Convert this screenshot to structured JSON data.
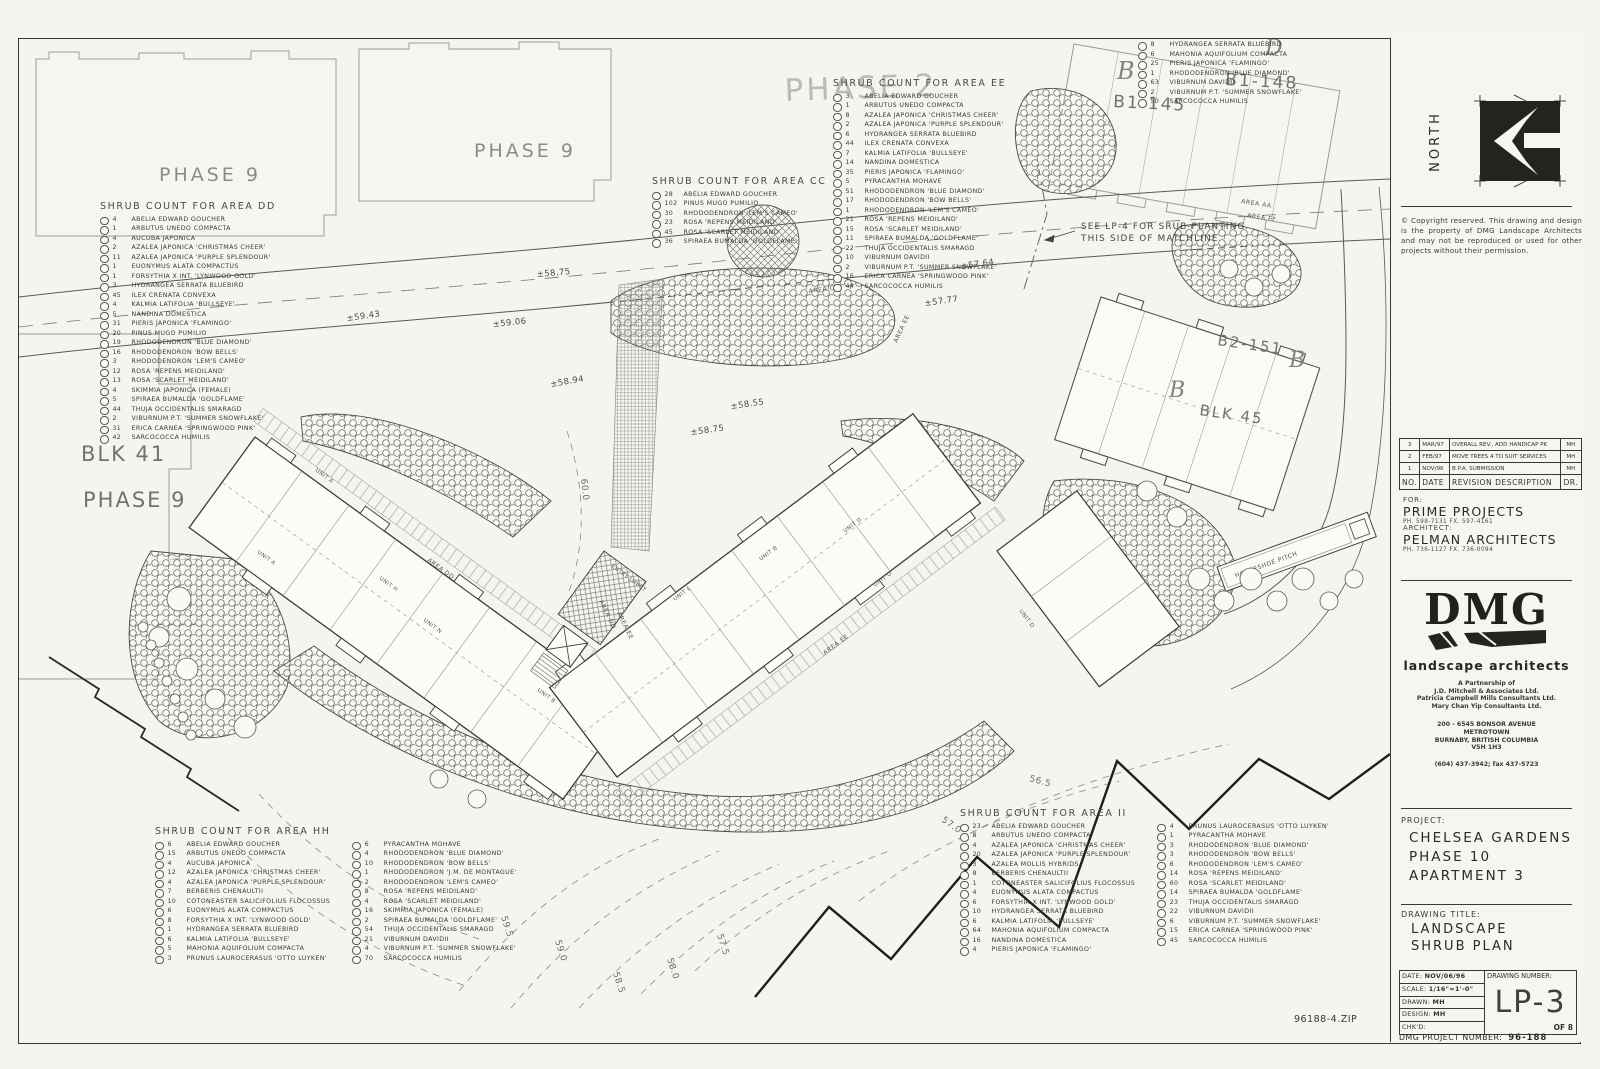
{
  "sheet": {
    "file_note": "96188-4.ZIP"
  },
  "titleblock": {
    "north_label": "NORTH",
    "copyright": "© Copyright reserved. This drawing and design is the property of DMG Landscape Architects and may not be reproduced or used for other projects without their permission.",
    "revisions": {
      "headers": {
        "no": "NO.",
        "date": "DATE",
        "desc": "REVISION  DESCRIPTION",
        "dr": "DR."
      },
      "rows": [
        {
          "no": "3",
          "date": "MAR/97",
          "desc": "OVERALL REV., ADD HANDICAP PK",
          "dr": "MH"
        },
        {
          "no": "2",
          "date": "FEB/97",
          "desc": "MOVE TREES 4 TO SUIT SERVICES",
          "dr": "MH"
        },
        {
          "no": "1",
          "date": "NOV/96",
          "desc": "B.P.A. SUBMISSION",
          "dr": "MH"
        }
      ]
    },
    "for_label": "FOR:",
    "client": "PRIME PROJECTS",
    "client_phone": "PH. 598-7131   FX. 597-4161",
    "architect_label": "ARCHITECT:",
    "architect": "PELMAN ARCHITECTS",
    "architect_phone": "PH. 736-1127   FX. 736-0094",
    "dmg": {
      "logo": "DMG",
      "tagline": "landscape architects",
      "partnership": [
        "A Partnership of",
        "J.D. Mitchell & Associates Ltd.",
        "Patricia Campbell Mills Consultants Ltd.",
        "Mary Chan Yip Consultants Ltd."
      ],
      "address": [
        "200 - 6545 BONSOR AVENUE",
        "METROTOWN",
        "BURNABY, BRITISH COLUMBIA",
        "V5H 1H3"
      ],
      "phone": "(604) 437-3942; fax 437-5723"
    },
    "project_label": "PROJECT:",
    "project_lines": [
      "CHELSEA GARDENS",
      "PHASE 10",
      "APARTMENT 3"
    ],
    "drawing_title_label": "DRAWING TITLE:",
    "drawing_title_lines": [
      "LANDSCAPE",
      "SHRUB PLAN"
    ],
    "info": {
      "date_label": "DATE:",
      "date": "NOV/06/96",
      "scale_label": "SCALE:",
      "scale": "1/16\"=1'-0\"",
      "drawn_label": "DRAWN:",
      "drawn": "MH",
      "design_label": "DESIGN:",
      "design": "MH",
      "chkd_label": "CHK'D:",
      "chkd": ""
    },
    "drawing_number_label": "DRAWING NUMBER:",
    "drawing_number": "LP-3",
    "of_note": "OF 8",
    "dmg_project_label": "DMG  PROJECT  NUMBER:",
    "dmg_project_number": "96-188"
  },
  "lists": {
    "dd": {
      "title": "SHRUB COUNT FOR AREA DD",
      "items": [
        {
          "q": "4",
          "n": "ABELIA EDWARD GOUCHER"
        },
        {
          "q": "1",
          "n": "ARBUTUS UNEDO COMPACTA"
        },
        {
          "q": "4",
          "n": "AUCUBA JAPONICA"
        },
        {
          "q": "2",
          "n": "AZALEA JAPONICA 'CHRISTMAS CHEER'"
        },
        {
          "q": "11",
          "n": "AZALEA JAPONICA 'PURPLE SPLENDOUR'"
        },
        {
          "q": "1",
          "n": "EUONYMUS ALATA COMPACTUS"
        },
        {
          "q": "1",
          "n": "FORSYTHIA X INT. 'LYNWOOD GOLD'"
        },
        {
          "q": "3",
          "n": "HYDRANGEA SERRATA BLUEBIRD"
        },
        {
          "q": "45",
          "n": "ILEX CRENATA CONVEXA"
        },
        {
          "q": "4",
          "n": "KALMIA LATIFOLIA 'BULLSEYE'"
        },
        {
          "q": "5",
          "n": "NANDINA DOMESTICA"
        },
        {
          "q": "31",
          "n": "PIERIS JAPONICA 'FLAMINGO'"
        },
        {
          "q": "20",
          "n": "PINUS MUGO PUMILIO"
        },
        {
          "q": "19",
          "n": "RHODODENDRON 'BLUE DIAMOND'"
        },
        {
          "q": "16",
          "n": "RHODODENDRON 'BOW BELLS'"
        },
        {
          "q": "3",
          "n": "RHODODENDRON 'LEM'S CAMEO'"
        },
        {
          "q": "12",
          "n": "ROSA 'REPENS MEIDILAND'"
        },
        {
          "q": "13",
          "n": "ROSA 'SCARLET MEIDILAND'"
        },
        {
          "q": "4",
          "n": "SKIMMIA JAPONICA (FEMALE)"
        },
        {
          "q": "5",
          "n": "SPIRAEA BUMALDA 'GOLDFLAME'"
        },
        {
          "q": "44",
          "n": "THUJA OCCIDENTALIS SMARAGD"
        },
        {
          "q": "2",
          "n": "VIBURNUM P.T. 'SUMMER SNOWFLAKE'"
        },
        {
          "q": "31",
          "n": "ERICA CARNEA 'SPRINGWOOD PINK'"
        },
        {
          "q": "42",
          "n": "SARCOCOCCA HUMILIS"
        }
      ]
    },
    "cc": {
      "title": "SHRUB COUNT FOR AREA CC",
      "items": [
        {
          "q": "28",
          "n": "ABELIA EDWARD GOUCHER"
        },
        {
          "q": "102",
          "n": "PINUS MUGO PUMILIO"
        },
        {
          "q": "30",
          "n": "RHODODENDRON 'LEM'S CAMEO'"
        },
        {
          "q": "23",
          "n": "ROSA 'REPENS MEIDILAND'"
        },
        {
          "q": "45",
          "n": "ROSA 'SCARLET MEIDILAND'"
        },
        {
          "q": "36",
          "n": "SPIRAEA BUMALDA 'GOLDFLAME'"
        }
      ]
    },
    "ee": {
      "title": "SHRUB COUNT FOR AREA EE",
      "items": [
        {
          "q": "3",
          "n": "ABELIA EDWARD GOUCHER"
        },
        {
          "q": "1",
          "n": "ARBUTUS UNEDO COMPACTA"
        },
        {
          "q": "8",
          "n": "AZALEA JAPONICA 'CHRISTMAS CHEER'"
        },
        {
          "q": "2",
          "n": "AZALEA JAPONICA 'PURPLE SPLENDOUR'"
        },
        {
          "q": "6",
          "n": "HYDRANGEA SERRATA BLUEBIRD"
        },
        {
          "q": "44",
          "n": "ILEX CRENATA CONVEXA"
        },
        {
          "q": "7",
          "n": "KALMIA LATIFOLIA 'BULLSEYE'"
        },
        {
          "q": "14",
          "n": "NANDINA DOMESTICA"
        },
        {
          "q": "35",
          "n": "PIERIS JAPONICA 'FLAMINGO'"
        },
        {
          "q": "5",
          "n": "PYRACANTHA MOHAVE"
        },
        {
          "q": "51",
          "n": "RHODODENDRON 'BLUE DIAMOND'"
        },
        {
          "q": "17",
          "n": "RHODODENDRON 'BOW BELLS'"
        },
        {
          "q": "1",
          "n": "RHODODENDRON 'LEM'S CAMEO'"
        },
        {
          "q": "21",
          "n": "ROSA 'REPENS MEIDILAND'"
        },
        {
          "q": "15",
          "n": "ROSA 'SCARLET MEIDILAND'"
        },
        {
          "q": "11",
          "n": "SPIRAEA BUMALDA 'GOLDFLAME'"
        },
        {
          "q": "22",
          "n": "THUJA OCCIDENTALIS SMARAGD"
        },
        {
          "q": "10",
          "n": "VIBURNUM DAVIDII"
        },
        {
          "q": "2",
          "n": "VIBURNUM P.T. 'SUMMER SNOWFLAKE'"
        },
        {
          "q": "16",
          "n": "ERICA CARNEA 'SPRINGWOOD PINK'"
        },
        {
          "q": "44",
          "n": "SARCOCOCCA HUMILIS"
        }
      ]
    },
    "tr": {
      "items": [
        {
          "q": "8",
          "n": "HYDRANGEA SERRATA BLUEBIRD"
        },
        {
          "q": "6",
          "n": "MAHONIA AQUIFOLIUM COMPACTA"
        },
        {
          "q": "25",
          "n": "PIERIS JAPONICA 'FLAMINGO'"
        },
        {
          "q": "1",
          "n": "RHODODENDRON 'BLUE DIAMOND'"
        },
        {
          "q": "63",
          "n": "VIBURNUM DAVIDII"
        },
        {
          "q": "2",
          "n": "VIBURNUM P.T. 'SUMMER SNOWFLAKE'"
        },
        {
          "q": "50",
          "n": "SARCOCOCCA HUMILIS"
        }
      ]
    },
    "hh": {
      "title": "SHRUB COUNT FOR AREA HH",
      "col1": [
        {
          "q": "6",
          "n": "ABELIA EDWARD GOUCHER"
        },
        {
          "q": "15",
          "n": "ARBUTUS UNEDO COMPACTA"
        },
        {
          "q": "4",
          "n": "AUCUBA JAPONICA"
        },
        {
          "q": "12",
          "n": "AZALEA JAPONICA 'CHRISTMAS CHEER'"
        },
        {
          "q": "4",
          "n": "AZALEA JAPONICA 'PURPLE SPLENDOUR'"
        },
        {
          "q": "7",
          "n": "BERBERIS CHENAULTII"
        },
        {
          "q": "10",
          "n": "COTONEASTER SALICIFOLIUS FLOCOSSUS"
        },
        {
          "q": "6",
          "n": "EUONYMUS ALATA COMPACTUS"
        },
        {
          "q": "8",
          "n": "FORSYTHIA X INT. 'LYNWOOD GOLD'"
        },
        {
          "q": "1",
          "n": "HYDRANGEA SERRATA BLUEBIRD"
        },
        {
          "q": "6",
          "n": "KALMIA LATIFOLIA 'BULLSEYE'"
        },
        {
          "q": "5",
          "n": "MAHONIA AQUIFOLIUM COMPACTA"
        },
        {
          "q": "3",
          "n": "PRUNUS LAUROCERASUS 'OTTO LUYKEN'"
        }
      ],
      "col2": [
        {
          "q": "6",
          "n": "PYRACANTHA MOHAVE"
        },
        {
          "q": "4",
          "n": "RHODODENDRON 'BLUE DIAMOND'"
        },
        {
          "q": "10",
          "n": "RHODODENDRON 'BOW BELLS'"
        },
        {
          "q": "1",
          "n": "RHODODENDRON 'J.M. DE MONTAGUE'"
        },
        {
          "q": "2",
          "n": "RHODODENDRON 'LEM'S CAMEO'"
        },
        {
          "q": "8",
          "n": "ROSA 'REPENS MEIDILAND'"
        },
        {
          "q": "4",
          "n": "ROSA 'SCARLET MEIDILAND'"
        },
        {
          "q": "16",
          "n": "SKIMMIA JAPONICA (FEMALE)"
        },
        {
          "q": "2",
          "n": "SPIRAEA BUMALDA 'GOLDFLAME'"
        },
        {
          "q": "54",
          "n": "THUJA OCCIDENTALIS SMARAGD"
        },
        {
          "q": "21",
          "n": "VIBURNUM DAVIDII"
        },
        {
          "q": "4",
          "n": "VIBURNUM P.T. 'SUMMER SNOWFLAKE'"
        },
        {
          "q": "70",
          "n": "SARCOCOCCA HUMILIS"
        }
      ]
    },
    "ii": {
      "title": "SHRUB COUNT FOR AREA II",
      "col1": [
        {
          "q": "23",
          "n": "ABELIA EDWARD GOUCHER"
        },
        {
          "q": "8",
          "n": "ARBUTUS UNEDO COMPACTA"
        },
        {
          "q": "4",
          "n": "AZALEA JAPONICA 'CHRISTMAS CHEER'"
        },
        {
          "q": "20",
          "n": "AZALEA JAPONICA 'PURPLE SPLENDOUR'"
        },
        {
          "q": "3",
          "n": "AZALEA MOLLIS HYBRIDS"
        },
        {
          "q": "8",
          "n": "BERBERIS CHENAULTII"
        },
        {
          "q": "1",
          "n": "COTONEASTER SALICIFOLIUS FLOCOSSUS"
        },
        {
          "q": "4",
          "n": "EUONYMUS ALATA COMPACTUS"
        },
        {
          "q": "6",
          "n": "FORSYTHIA X INT. 'LYNWOOD GOLD'"
        },
        {
          "q": "10",
          "n": "HYDRANGEA SERRATA BLUEBIRD"
        },
        {
          "q": "6",
          "n": "KALMIA LATIFOLIA 'BULLSEYE'"
        },
        {
          "q": "64",
          "n": "MAHONIA AQUIFOLIUM COMPACTA"
        },
        {
          "q": "16",
          "n": "NANDINA DOMESTICA"
        },
        {
          "q": "4",
          "n": "PIERIS JAPONICA 'FLAMINGO'"
        }
      ],
      "col2": [
        {
          "q": "4",
          "n": "PRUNUS LAUROCERASUS 'OTTO LUYKEN'"
        },
        {
          "q": "1",
          "n": "PYRACANTHA MOHAVE"
        },
        {
          "q": "3",
          "n": "RHODODENDRON 'BLUE DIAMOND'"
        },
        {
          "q": "3",
          "n": "RHODODENDRON 'BOW BELLS'"
        },
        {
          "q": "6",
          "n": "RHODODENDRON 'LEM'S CAMEO'"
        },
        {
          "q": "14",
          "n": "ROSA 'REPENS MEIDILAND'"
        },
        {
          "q": "60",
          "n": "ROSA 'SCARLET MEIDILAND'"
        },
        {
          "q": "14",
          "n": "SPIRAEA BUMALDA 'GOLDFLAME'"
        },
        {
          "q": "23",
          "n": "THUJA OCCIDENTALIS SMARAGD"
        },
        {
          "q": "22",
          "n": "VIBURNUM DAVIDII"
        },
        {
          "q": "6",
          "n": "VIBURNUM P.T. 'SUMMER SNOWFLAKE'"
        },
        {
          "q": "15",
          "n": "ERICA CARNEA 'SPRINGWOOD PINK'"
        },
        {
          "q": "45",
          "n": "SARCOCOCCA HUMILIS"
        }
      ]
    }
  },
  "plan": {
    "labels": {
      "phase9": "PHASE 9",
      "phase2": "PHASE 2",
      "blk41": "BLK 41",
      "b1_148": "B1-148",
      "b1_145": "B1-145",
      "b2_151": "B2-151",
      "blk45": "BLK 45",
      "b": "B",
      "d": "D",
      "note1": "SEE LP-4 FOR SRUB PLANTING",
      "note2": "THIS SIDE OF MATCHLINE",
      "horseshoe": "HORSESHOE PITCH",
      "entry": "ENTRY LOBBY",
      "area_aa": "AREA AA",
      "area_ff": "AREA FF",
      "area_cc": "AREA CC",
      "area_dd": "AREA DD",
      "area_ee": "AREA EE",
      "elev": {
        "e1": "±58.75",
        "e2": "±59.43",
        "e3": "±59.06",
        "e4": "±58.94",
        "e5": "±58.55",
        "e6": "±58.75",
        "e7": "±57.64",
        "e8": "±57.77"
      },
      "cont": {
        "c1": "60.0",
        "c2": "59.5",
        "c3": "59.0",
        "c4": "58.5",
        "c5": "58.0",
        "c6": "57.5",
        "c7": "57.0",
        "c8": "56.5"
      },
      "units": {
        "u1": "UNIT A",
        "u2": "UNIT H",
        "u3": "UNIT N",
        "u4": "UNIT B",
        "u5": "UNIT L",
        "u6": "UNIT B",
        "u7": "UNIT D",
        "u8": "UNIT O",
        "u9": "UNIT A",
        "u10": "UNIT D"
      }
    }
  }
}
